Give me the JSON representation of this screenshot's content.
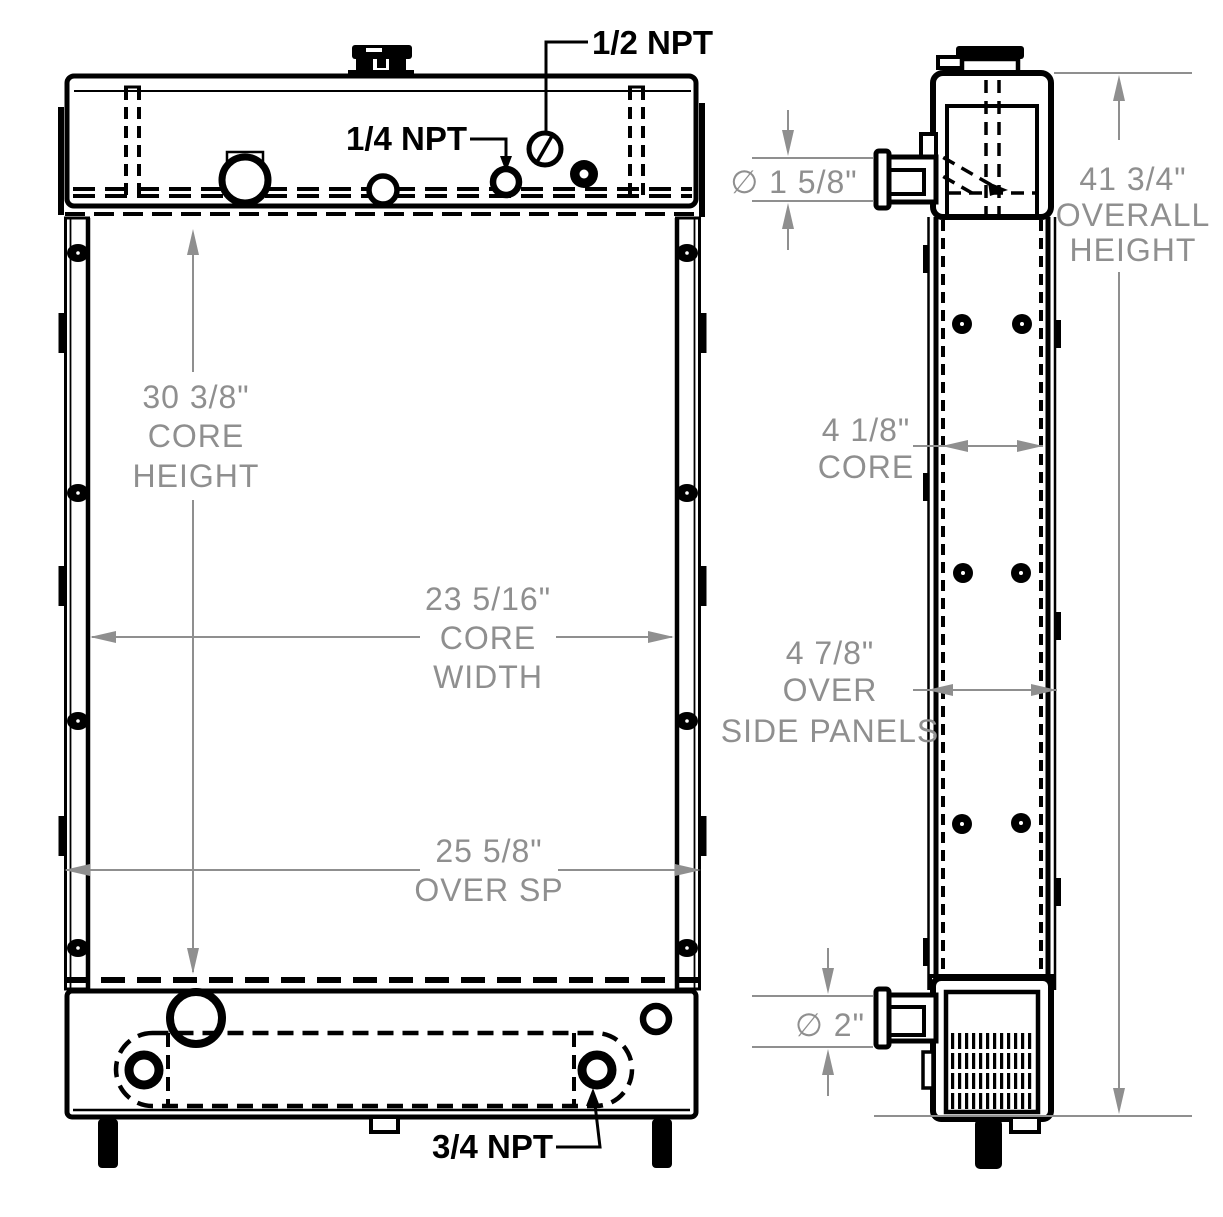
{
  "title": "Radiator engineering drawing, front and side views",
  "labels": {
    "half_npt": "1/2 NPT",
    "quarter_npt": "1/4 NPT",
    "three_quarter_npt": "3/4 NPT"
  },
  "front_dimensions": {
    "core_height_value": "30 3/8\"",
    "core_height_line2": "CORE",
    "core_height_line3": "HEIGHT",
    "core_width_value": "23 5/16\"",
    "core_width_line2": "CORE",
    "core_width_line3": "WIDTH",
    "over_sp_value": "25 5/8\"",
    "over_sp_label": "OVER SP"
  },
  "side_dimensions": {
    "inlet_diameter_value": "∅ 1 5/8\"",
    "overall_height_value": "41 3/4\"",
    "overall_height_line2": "OVERALL",
    "overall_height_line3": "HEIGHT",
    "core_depth_value": "4 1/8\"",
    "core_depth_label": "CORE",
    "over_side_panels_value": "4 7/8\"",
    "over_side_panels_line2": "OVER",
    "over_side_panels_line3": "SIDE PANELS",
    "outlet_diameter_value": "∅ 2\""
  },
  "colors": {
    "line": "#000000",
    "dimension": "#8f8f8f",
    "background": "#ffffff"
  }
}
